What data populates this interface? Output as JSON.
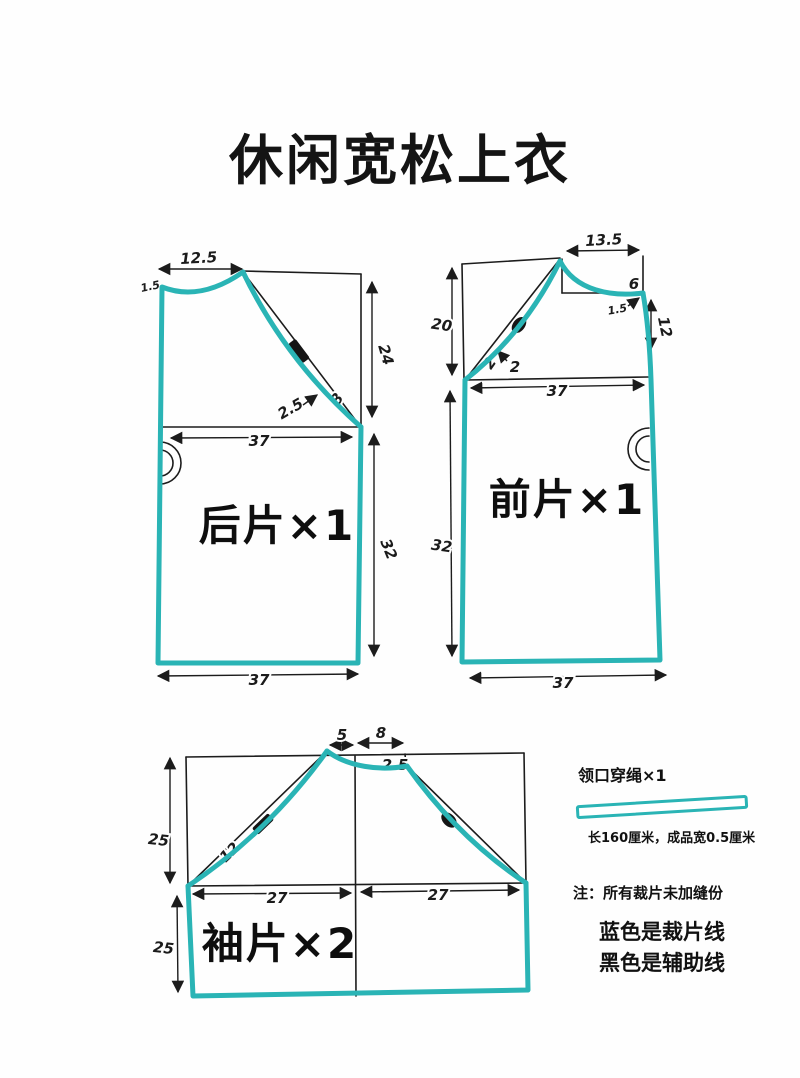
{
  "title": "休闲宽松上衣",
  "colors": {
    "cut_line_teal": "#2ab4b5",
    "aux_line_black": "#1c1c1c"
  },
  "back": {
    "label": "后片×1",
    "neck_width": "12.5",
    "neck_drop": "1.5",
    "raglan_depth": "24",
    "chest_width": "37",
    "side_length": "32",
    "hem_width": "37",
    "curve_gap": "2.5",
    "raglan_segment": "8"
  },
  "front": {
    "label": "前片×1",
    "shoulder_width": "13.5",
    "neck_depth": "6",
    "neck_gap": "1.5",
    "front_edge": "12",
    "raglan_depth": "20",
    "curve_gap_a": "2",
    "curve_gap_b": "2",
    "chest_width": "37",
    "side_length": "32",
    "hem_width": "37"
  },
  "sleeve": {
    "label": "袖片×2",
    "cap_top_left": "5",
    "cap_top_right": "8",
    "cap_drop": "2.5",
    "cap_height": "25",
    "curve_label": "12",
    "underarm_left": "27",
    "underarm_right": "27",
    "lower_length": "25"
  },
  "drawstring": {
    "label": "领口穿绳×1",
    "spec": "长160厘米，成品宽0.5厘米"
  },
  "notes": {
    "note": "注：所有裁片未加缝份",
    "legend_blue": "蓝色是裁片线",
    "legend_black": "黑色是辅助线"
  }
}
